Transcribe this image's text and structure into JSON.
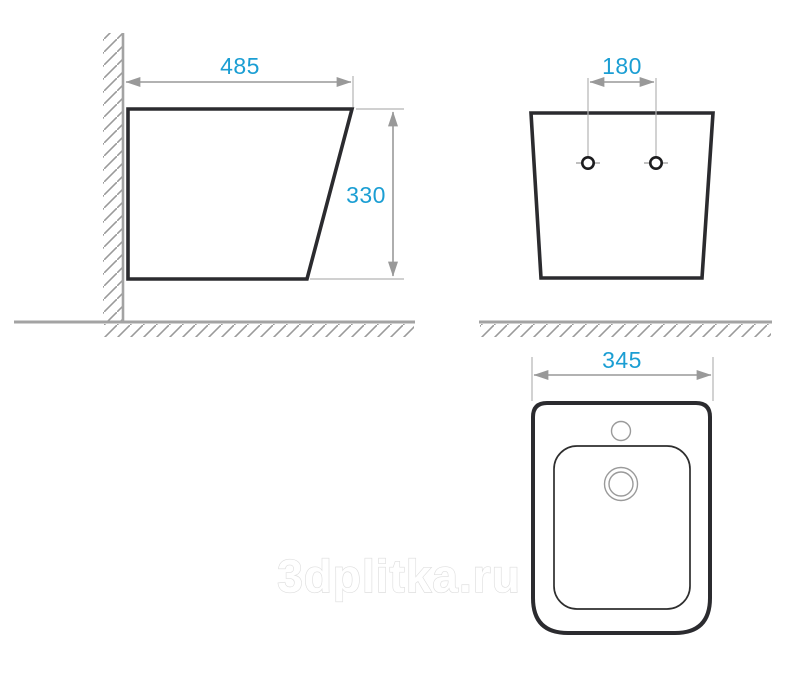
{
  "diagram": {
    "type": "technical-dimension-drawing",
    "subject": "wall-hung bidet, three orthographic views",
    "views": {
      "side": {
        "width_label": "485",
        "height_label": "330"
      },
      "front": {
        "hole_spacing_label": "180"
      },
      "top": {
        "width_label": "345"
      }
    },
    "watermark": "3dplitka.ru",
    "colors": {
      "dimension_text": "#1b9ed3",
      "dimension_arrows": "#999999",
      "extension_lines": "#b3b3b3",
      "outline_dark": "#2b2b2f",
      "wall_ground_gray": "#a3a3a3",
      "thin_detail_gray": "#9a9a9a",
      "watermark_outline": "#dedede",
      "background": "#ffffff"
    }
  }
}
